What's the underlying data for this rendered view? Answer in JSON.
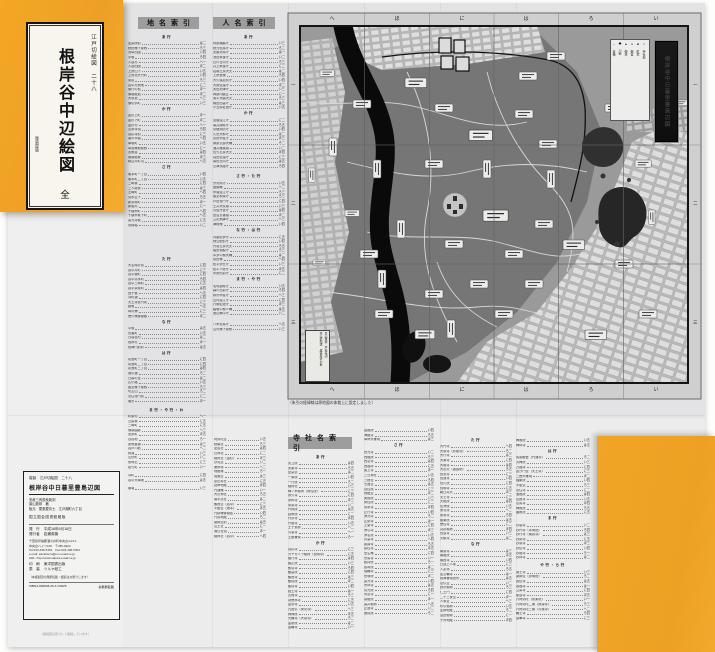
{
  "cover": {
    "series": "江戸切絵図　二十八",
    "title": "根岸谷中辺絵図",
    "volume": "全",
    "publisher_mark": "尾張屋版"
  },
  "headers": {
    "place": "地名索引",
    "person": "人名索引",
    "temple": "寺社名索引"
  },
  "map": {
    "title": "根岸谷中日暮里豊島辺図",
    "caption": "（朱引の経緯線は原地図の体裁上に設定しました）",
    "top_labels": [
      "へ",
      "ほ",
      "に",
      "は",
      "ろ",
      "い"
    ],
    "side_labels": [
      "一",
      "二",
      "三"
    ],
    "legend": [
      "□ 寺社地",
      "■ 町家",
      "● 御宮",
      "▲ 御林",
      "◆ 川筋",
      "─ 道橋"
    ],
    "strip1": "景山致恭　戸松昌訓",
    "strip2": "井山能知述　尾張屋清七板"
  },
  "place_index": [
    {
      "label": "あ行",
      "rows": [
        "愛染院前|は二",
        "秋田様下屋敷|ろ三",
        "浅草田圃|い四",
        "芋坂|ろ四",
        "入谷村|へ一",
        "入谷田圃|ほ二",
        "上野山下|い五",
        "上野北大門町|い四",
        "鶯谷|ろ三",
        "谷中村飛地|に二",
        "御行の松|ほ一",
        "御隠殿道|ほ二",
        "大塚道|へ三",
        "御切手町|い三"
      ]
    },
    {
      "label": "か行",
      "rows": [
        "金杉上町|ほ一",
        "金杉下町|ほ二",
        "金杉村|へ一",
        "寛永寺領|ろ四",
        "感応寺前|に三",
        "亀の甲橋|へ四",
        "車坂町|い五",
        "草間様抱屋敷|に一",
        "黒鍬谷|は四",
        "御隠殿坂|ほ三",
        "駒込片町境|へ五"
      ]
    },
    {
      "label": "さ行",
      "rows": [
        "坂本町一丁目|い四",
        "坂本町二丁目|い五",
        "三崎坂|に四",
        "三人屋敷|は三",
        "芝崎町|へ四",
        "清水堂下|ろ五",
        "新茶屋町|ほ一",
        "新堀村|に一",
        "千駄木町|へ四",
        "千駄木坂下町|へ五",
        "善光寺坂|に五",
        "惣構堀|い二"
      ]
    },
    {
      "label": "た行",
      "gap": 28,
      "rows": [
        "大名時計前|に四",
        "谷中片町|に三",
        "谷中坂町|に四",
        "谷中清水町|ろ四",
        "谷中三崎町|に五",
        "谷中茶屋町|は四",
        "団子坂|へ五",
        "寺町通|に四",
        "天王寺表門前|に三",
        "動坂|へ五",
        "時の鐘|に三",
        "徳川様御隠殿|ほ二"
      ]
    },
    {
      "label": "な行",
      "rows": [
        "中坂|は五",
        "長者町|い五",
        "日暮里村|は二",
        "根岸村|ほ一",
        "根津門前町|は五"
      ]
    },
    {
      "label": "は行",
      "rows": [
        "初音町一丁目|に四",
        "初音町二丁目|に四",
        "初音町三丁目|は四",
        "畑中通|ろ二",
        "日暮の里|は二",
        "広小路|い五",
        "藤堂様下屋敷|ろ三",
        "坊主山|ろ二",
        "法住寺門前|に二",
        "螢沢|ほ一"
      ]
    },
    {
      "label": "ま行・や行・わ",
      "gap": 3,
      "rows": [
        "町屋村|へ一",
        "豆腐坂|に五",
        "三崎町|に五",
        "御薬園跡|へ三",
        "宮永町|ほ五",
        "百姓地|ろ一",
        "屋敷裏通|は三",
        "谷戸川筋|へ二",
        "柳通|い三",
        "山伏町|い二",
        "夜啼石|に三",
        "若竹町|い一"
      ]
    },
    {
      "gap": 4,
      "rows": [
        "寺町|に四",
        "谷中大車坂|は五"
      ]
    },
    {
      "gap": 4,
      "rows": [
        "番場|い三"
      ]
    }
  ],
  "person_index": [
    {
      "label": "あ行",
      "rows": [
        "阿部播磨守|い三",
        "秋元但馬守|ろ二",
        "安藤対馬守|は一",
        "池田筑後守|い二",
        "石川日向守|ろ三",
        "井上筑後守|に二",
        "岩城左京大夫|は二",
        "上野宮様|ろ四",
        "大久保加賀守|い四",
        "大関信濃守|ほ二",
        "太田摂津守|い三",
        "岡部内膳正|に一",
        "奥平大膳大夫|ろ三",
        "織田出雲守|は三",
        "小笠原佐渡守|い五"
      ]
    },
    {
      "label": "か行",
      "rows": [
        "加藤遠江守|に二",
        "亀井隠岐守|ろ五",
        "京極周防守|い四",
        "久世大和守|は二",
        "黒田甲斐守|ほ三",
        "榊原式部大輔|ろ二",
        "酒井雅楽頭|い二",
        "佐竹右京大夫|ほ四",
        "真田信濃守|に三",
        "柴田日向守|は五",
        "島津淡路守|ろ四"
      ]
    },
    {
      "label": "さ行・た行",
      "gap": 4,
      "rows": [
        "宗対馬守|い五",
        "醍醐様|へ二",
        "伊達遠江守|ろ三",
        "藤堂和泉守|ろ三",
        "戸田長門守|に四",
        "土井大炊頭|い三",
        "鳥居丹波守|は四",
        "田沼玄蕃頭|ほ二",
        "立花飛騨守|へ三",
        "津軽様|い四"
      ]
    },
    {
      "label": "な行・は行",
      "rows": [
        "内藤紀伊守|に五",
        "鍋島肥前守|い四",
        "丹羽左京大夫|ろ五",
        "堀田相模守|ろ三",
        "本多中務大輔|は二",
        "前田様|へ四",
        "松平伊豆守|い三",
        "松平下総守|ほ五",
        "水野出羽守|に二"
      ]
    },
    {
      "label": "ま行・や行",
      "rows": [
        "毛利讃岐守|い五",
        "森川出羽守|ろ四",
        "柳沢甲斐守|へ三",
        "山内遠江守|に四",
        "六郷佐渡守|ほ三",
        "脇坂中務少輔|は五",
        "渡辺備中守|い二"
      ]
    },
    {
      "gap": 6,
      "rows": [
        "八木但馬守|へ五",
        "山内様下屋敷|い三"
      ]
    }
  ],
  "temple_index_col0": [
    {
      "rows": [
        "阿弥陀堂|い五",
        "秋葉社|ろ三",
        "愛宕社|は四",
        "石神社|に二",
        "稲荷社（金杉）|ほ三",
        "妙見堂|い二",
        "庚申塚|へ二",
        "地蔵尊|ろ一",
        "閻魔堂|は三",
        "恵比寿社|に五",
        "延命地蔵|ほ四",
        "円通庵|い一",
        "大鳥神社|ろ五",
        "御手洗社|は二",
        "観音堂（谷中）|に三",
        "不動堂（坂本）|ほ五",
        "門跡様御隠居|い四",
        "門前地蔵|ろ二",
        "薬師堂前|は五",
        "山王社|に一",
        "湯島社領|ほ一",
        "稲荷社（谷中）|へ四"
      ]
    }
  ],
  "temple_index_col1": [
    {
      "label": "あ行",
      "rows": [
        "安立院|は四",
        "安楽寺|ろ五",
        "愛染堂|は二",
        "一乗院|い四",
        "一行院|ろ二",
        "稲荷社|い三",
        "梅ノ木稲荷（修性院）|に三",
        "永久寺|に四",
        "永称寺|ほ三",
        "栄泉寺|い二",
        "円珠院|は五",
        "延命院|に二",
        "円妙寺|ほ四",
        "円隆寺|い五",
        "王子道標|へ二",
        "青雲寺|へ一",
        "王殿権現|ろ一"
      ]
    },
    {
      "label": "か行",
      "rows": [
        "感応寺|に三",
        "カヤカヅラ稲荷（長明寺）|に五",
        "願行寺|は四",
        "願正院|い三",
        "歓喜寺|ろ四",
        "観智院|に四",
        "観音寺|は三",
        "観成院|ほ二",
        "願成寺|い四",
        "経王寺|は一",
        "玄照寺|ろ三",
        "功徳林寺|に五",
        "金嶺寺|い五",
        "九品仏（東覚寺）|へ三",
        "興禅院|ほ五",
        "光輪寺（大泉寺）|ろ二",
        "金剛院|は二",
        "金輪寺|い一"
      ]
    }
  ],
  "temple_index_col2": [
    {
      "rows": [
        "金蔵院|い四",
        "海蔵寺|ろ五",
        "幸神大権現|は三"
      ]
    },
    {
      "label": "さ行",
      "rows": [
        "西光寺|い二",
        "西蔵院|ろ三",
        "西念寺|は四",
        "西福寺|に五",
        "最上寺|ほ一",
        "三島神社|い五",
        "三峰社|ろ四",
        "七面堂|は五",
        "自性院|に三",
        "地蔵堂|ほ二",
        "実相院|い三",
        "修性院|に二",
        "寿永寺|ほ四",
        "正行寺|い四",
        "浄光寺|ろ二",
        "正慶寺|は一",
        "上聖寺|に四",
        "浄心寺|ほ三",
        "浄名院|い五",
        "青雲寺|へ四",
        "誠諦寺|ろ五",
        "善性寺|ほ五",
        "全生庵|に四",
        "宗善寺|い一",
        "総持院|ろ一",
        "養寿院|は二",
        "瑞輪寺|に三",
        "世尊院|ほ二",
        "善光寺|い四",
        "宗林寺|は五",
        "清光院|ろ四",
        "専念寺|に一",
        "泉蔵院|ほ一",
        "染井稲荷|へ五",
        "正運寺|い二",
        "速成院|ろ二"
      ]
    }
  ],
  "temple_index_col3": [
    {
      "label": "た行",
      "rows": [
        "大円寺|へ四",
        "大泉寺（妙隆寺）|ろ二",
        "大行寺|は三",
        "大乗寺|に四",
        "大雄寺|は四",
        "大黒天（護国院）|ろ五",
        "長安寺|に三",
        "長運寺|い四",
        "長久院|に四",
        "長明寺|に五",
        "朝日弁天|ほ三",
        "天王寺|に三",
        "天龍院|は四",
        "伝浄院|い五",
        "東覚寺|へ二",
        "東漸寺|ろ四",
        "藤乗院|は五",
        "徳性寺|に二",
        "突抜稲荷|ほ四",
        "長遠寺|い三",
        "天眼寺|は二"
      ]
    },
    {
      "label": "な行",
      "rows": [
        "南泉寺|は三",
        "南蔵院|ほ五",
        "南昌寺|い四",
        "日蓮上人塚|に三",
        "入定塚|ろ五",
        "如意輪寺|は一",
        "根津権現旅所|は五",
        "念仏堂|い二",
        "野沢稲荷|ろ三",
        "仁王門|に四",
        "二十三夜堂|ほ一",
        "人参堂|へ三",
        "布引稲荷|い五",
        "塗師地蔵|ろ二",
        "沼田稲荷|に一",
        "子育地蔵|ほ四"
      ]
    }
  ],
  "temple_index_col4": [
    {
      "rows": [
        "梅翁院|い五",
        "梅林寺|は五"
      ]
    },
    {
      "label": "は行",
      "rows": [
        "馬頭観音（円通寺）|ろ二",
        "芳梅院|い三",
        "万福寺|に四",
        "毘沙門堂（天王寺）|に三",
        "三囲大権現|ほ二",
        "福聚院|い四",
        "不動堂|ろ三",
        "法住寺|に二",
        "宝蔵院|は四",
        "法昌寺|い五",
        "法善寺|ほ四",
        "梅照院|ろ五",
        "遍照院|に五"
      ]
    },
    {
      "label": "ま行",
      "rows": [
        "妙雲寺|い二",
        "妙円寺（本明院）|ろ四",
        "妙行寺（南谷寺）|は三",
        "妙慶寺|に五",
        "妙泉寺|ほ三",
        "妙伝寺|い四",
        "妙隆寺|ろ一",
        "妙林寺|は二"
      ]
    },
    {
      "label": "や行・ら行",
      "gap": 2,
      "rows": [
        "薬王寺|い三",
        "薬師堂（永明院）|ろ二",
        "養伝寺|は五",
        "養福寺|は一",
        "立善寺|に四",
        "龍谷寺|ほ五",
        "六阿弥陀（常楽院）|い一",
        "六阿弥陀二番（無量寺）|ろ三",
        "六阿弥陀三番（与楽寺）|へ二",
        "輪王寺|ろ四",
        "蓮華寺|に三"
      ]
    }
  ],
  "colophon": {
    "series_line": "複製　江戸切絵図　二十八",
    "title": "根岸谷中日暮里豊島辺図",
    "orig1": "安政三丙辰秋新刻",
    "orig2": "景山致恭　著",
    "orig3": "板元　尾張屋清七　江戸麹町六丁目",
    "source": "国立国会図書館蔵版",
    "pub_label": "発　行",
    "pub_value": "平成16年9月18日",
    "puber_label": "発行者",
    "puber_value": "岩瀬英機",
    "addr1": "千葉県印旛郡酒々井町中央台4-23-1",
    "addr2": "中央台ハイツ106　〒285-0922",
    "addr3": "Tel:043-496-5454　Fax:043-496-5454",
    "addr4": "e-mail: edokiriezu@mx.email.ne.jp",
    "addr5": "URL: http://www.sakura.email.ne.jp",
    "print_label": "印　刷",
    "print_value": "東洋図書出版",
    "bind_label": "表　装",
    "bind_value": "ツルヤ紙工",
    "note": "（本複製図の無断転載・複製はお断りします）",
    "isbn": "ISBN4-900838-29-4 C0625",
    "no_reprint": "禁無断転載"
  },
  "footer_note": "（複製図は原寸にて複製しています）"
}
